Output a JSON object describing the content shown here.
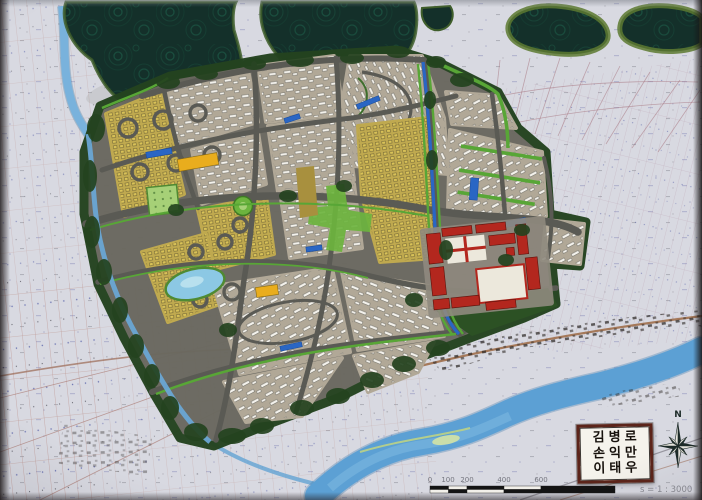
{
  "title_box": {
    "names": [
      "김병로",
      "손익만",
      "이태우"
    ]
  },
  "compass": {
    "north_label": "N"
  },
  "scale_bar": {
    "labels": [
      "0",
      "100",
      "200",
      "400",
      "600",
      "1000"
    ],
    "ratio_text": "s = 1 : 3000"
  },
  "colors": {
    "paper": "#d8d9e1",
    "forest": "#14302a",
    "forest_fringe": "#5d7a32",
    "road_gray": "#5a5a54",
    "plan_ground": "#6a685f",
    "block_tan": "#b1a897",
    "block_yellow": "#bfa94f",
    "building_white": "#f4f2ec",
    "park_green": "#6cb43e",
    "park_light": "#a6d077",
    "street_green": "#58a636",
    "tree_dark": "#24431f",
    "canal_blue": "#2a66c4",
    "river_blue": "#5ca0d4",
    "stream_blue": "#79b2dc",
    "pond_blue": "#8cc8e4",
    "red_complex": "#b3271e",
    "facility_yellow": "#e9ad1d",
    "parcel_line": "#b97d73",
    "village_dark": "#2d2824",
    "label_gray": "#74757e",
    "box_border": "#5c241a",
    "scale_black": "#141414"
  }
}
